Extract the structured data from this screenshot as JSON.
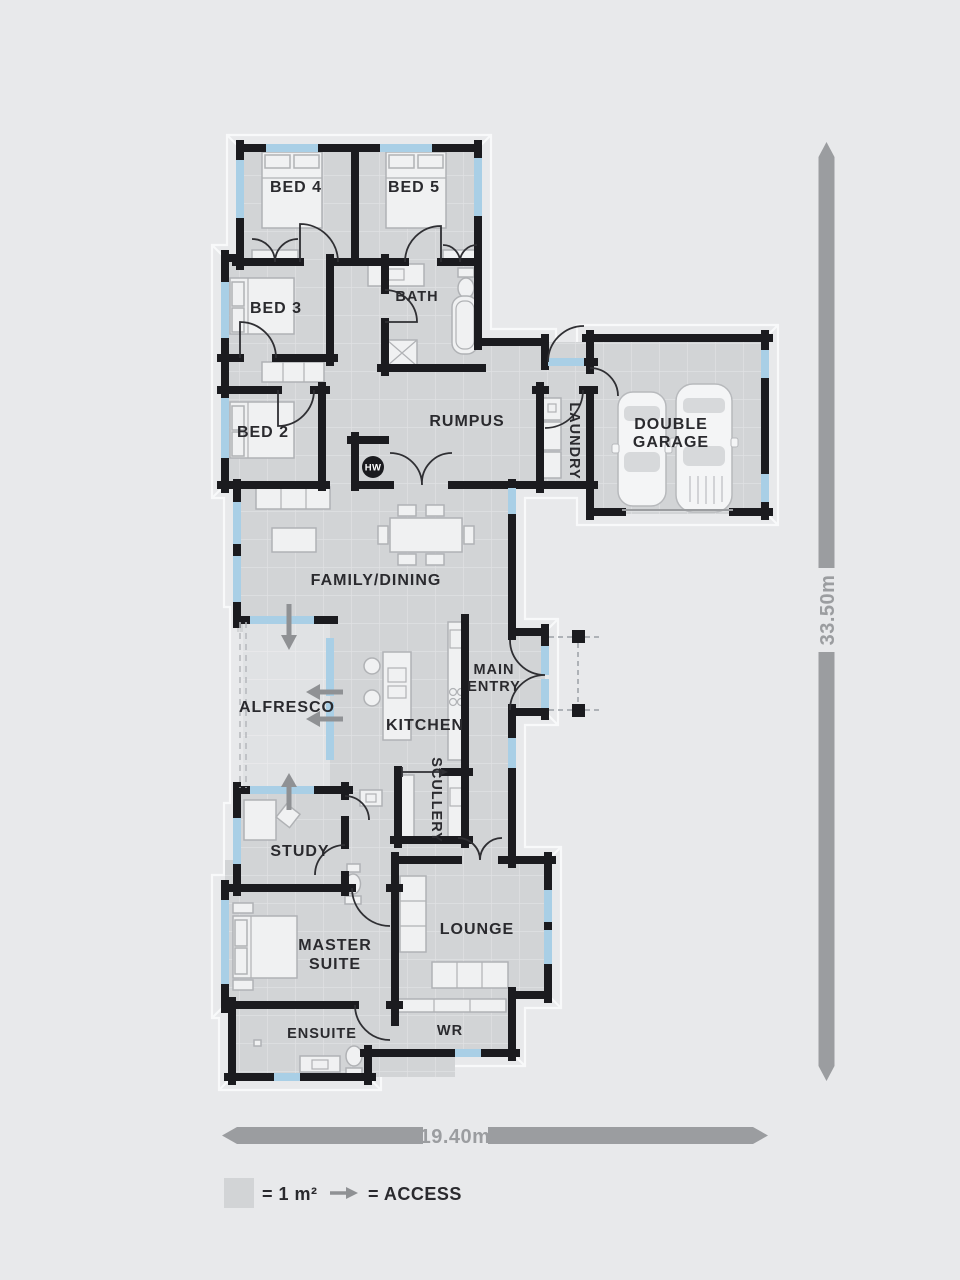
{
  "plan": {
    "title_hidden": "",
    "labels": {
      "bed4": "BED 4",
      "bed5": "BED 5",
      "bed3": "BED 3",
      "bath": "BATH",
      "bed2": "BED 2",
      "rumpus": "RUMPUS",
      "laundry": "LAUNDRY",
      "double_garage_line1": "DOUBLE",
      "double_garage_line2": "GARAGE",
      "family_dining": "FAMILY/DINING",
      "alfresco": "ALFRESCO",
      "main_entry_line1": "MAIN",
      "main_entry_line2": "ENTRY",
      "kitchen": "KITCHEN",
      "scullery": "SCULLERY",
      "study": "STUDY",
      "master_suite_line1": "MASTER",
      "master_suite_line2": "SUITE",
      "lounge": "LOUNGE",
      "ensuite": "ENSUITE",
      "wr": "WR",
      "hot_water": "HW"
    },
    "dimensions": {
      "depth": "33.50m",
      "width": "19.40m"
    },
    "legend": {
      "area_label": "= 1 m²",
      "access_label": "= ACCESS"
    },
    "colors": {
      "background": "#e8e9eb",
      "floor": "#d2d4d6",
      "floor_outdoor": "#e0e2e4",
      "grid_line": "#e0e1e3",
      "wall": "#1b1b1f",
      "window": "#a9cfe6",
      "access_arrow": "#8f9194",
      "dimension": "#9b9da0",
      "label_text": "#2a2a2e"
    }
  }
}
